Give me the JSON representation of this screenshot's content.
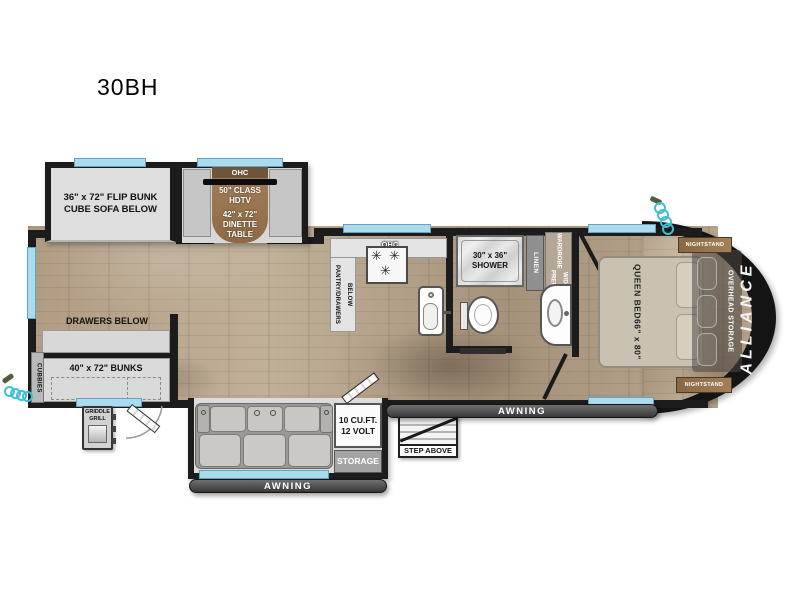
{
  "model": "30BH",
  "brand": "ALLIANCE",
  "colors": {
    "wall": "#1c1c1c",
    "wood_floor": "#b3a189",
    "slide_interior": "#dcdcdc",
    "window_blue": "#aadced",
    "cabinet_brown": "#96734c",
    "awning_gray": "#4a4a4a",
    "power_cord_teal": "#3fbfd6"
  },
  "bunk_room": {
    "flip_bunk_line1": "36\" x 72\" FLIP BUNK",
    "flip_bunk_line2": "CUBE SOFA BELOW",
    "drawers_below": "DRAWERS BELOW",
    "bunks": "40\" x 72\" BUNKS",
    "cubbies": "CUBBIES"
  },
  "dinette": {
    "ohc": "OHC",
    "tv_line1": "50\" CLASS",
    "tv_line2": "HDTV",
    "table_line1": "42\" x 72\"",
    "table_line2": "DINETTE",
    "table_line3": "TABLE"
  },
  "kitchen": {
    "ohc": "OHC",
    "pantry": "PANTRY/DRAWERS BELOW"
  },
  "bathroom": {
    "shower_line1": "30\" x 36\"",
    "shower_line2": "SHOWER",
    "linen": "LINEN",
    "wardrobe_line1": "WARDROBE",
    "wardrobe_line2": "W/D PREP"
  },
  "bedroom": {
    "bed_line1": "QUEEN BED",
    "bed_line2": "66\" x 80\"",
    "overhead_storage": "OVERHEAD STORAGE",
    "nightstand_top": "NIGHTSTAND",
    "nightstand_bottom": "NIGHTSTAND"
  },
  "living": {
    "fridge_line1": "10 CU.FT.",
    "fridge_line2": "12 VOLT",
    "storage": "STORAGE"
  },
  "exterior": {
    "griddle_line1": "GRIDDLE",
    "griddle_line2": "GRILL",
    "step_above": "STEP ABOVE",
    "awning_left": "AWNING",
    "awning_right": "AWNING"
  }
}
